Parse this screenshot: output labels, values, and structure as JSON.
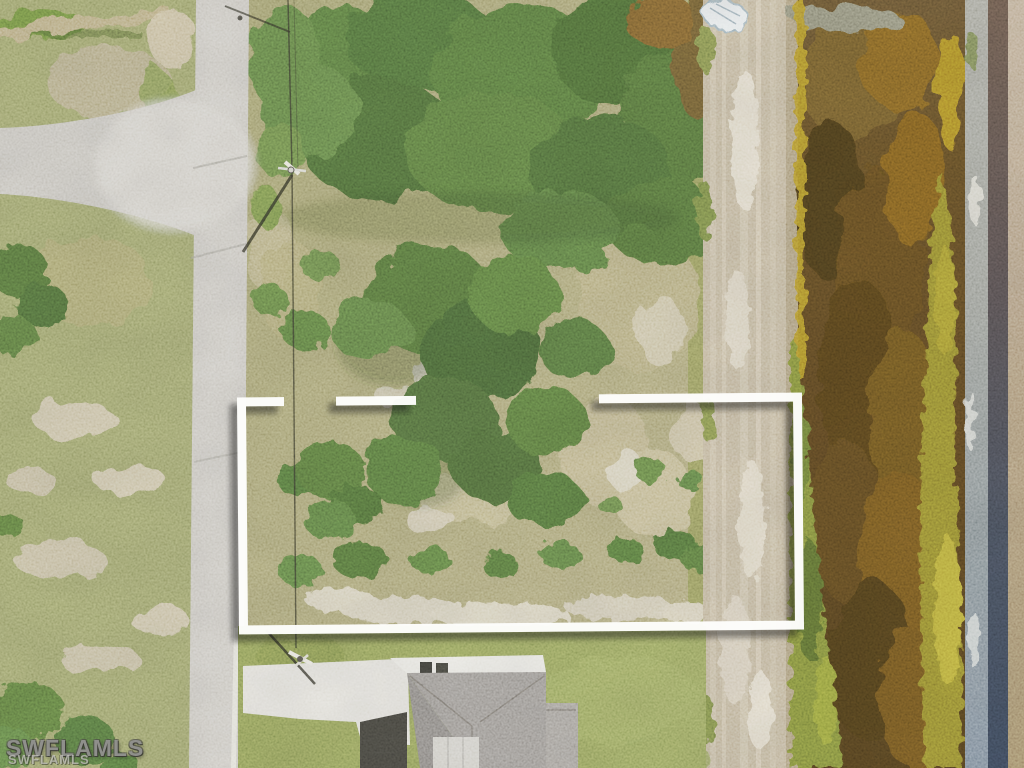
{
  "image": {
    "kind": "aerial-real-estate-photo",
    "description": "Overhead drone photo of a vacant brush-covered residential lot outlined with a white segmented rectangle, bordered by a paved street on the left, a sandy maintenance path and brown canal on the right, and a gray-roofed house at the bottom"
  },
  "watermark": {
    "primary": "SWFLAMLS",
    "secondary": "SWFLAMLS"
  },
  "overlay": {
    "boundary_color": "#fdfdfb",
    "boundary_style": "segmented-rectangle-with-drop-shadow"
  },
  "palette": {
    "road": "#cbc8c1",
    "road_intersection": "#d7d4cd",
    "grass_left": "#9aa06b",
    "lot_ground": "#a8a176",
    "vegetation_dark": "#4a6438",
    "vegetation_mid": "#5d7a44",
    "sand_patch": "#d5cfba",
    "footpath": "#c0b49a",
    "canal_water_dark": "#584322",
    "canal_water_amber": "#7d5f25",
    "canal_edge_amber": "#b2922f",
    "algae_green": "#7c883e",
    "algae_yellow": "#9a8c33",
    "rock_band": "#9c9c94",
    "gravel_band": "#46474f",
    "right_bank_dirt": "#b5a184",
    "lawn": "#8c9a58",
    "roof_shingle": "#9b9792",
    "driveway_concrete": "#e3e1da",
    "shadow": "#33322a"
  }
}
